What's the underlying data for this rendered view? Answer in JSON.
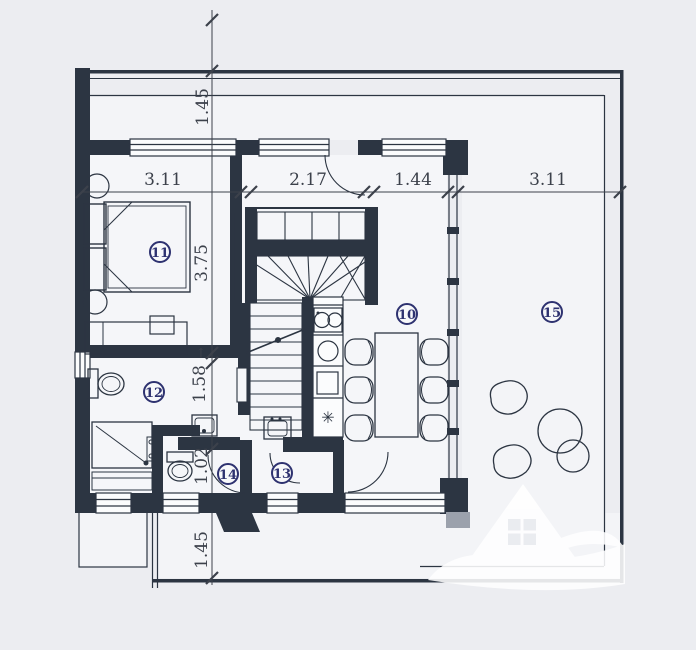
{
  "plan": {
    "type": "apartment-floor-plan",
    "rooms": [
      {
        "number": "11",
        "x": 160,
        "y": 252
      },
      {
        "number": "12",
        "x": 154,
        "y": 392
      },
      {
        "number": "14",
        "x": 228,
        "y": 474
      },
      {
        "number": "13",
        "x": 282,
        "y": 473
      },
      {
        "number": "10",
        "x": 407,
        "y": 314
      },
      {
        "number": "15",
        "x": 552,
        "y": 312
      }
    ],
    "dimensions": {
      "horizontal": [
        {
          "label": "3.11",
          "x": 163,
          "y": 180
        },
        {
          "label": "2.17",
          "x": 308,
          "y": 180
        },
        {
          "label": "1.44",
          "x": 413,
          "y": 180
        },
        {
          "label": "3.11",
          "x": 548,
          "y": 180
        }
      ],
      "vertical": [
        {
          "label": "1.45",
          "x": 203,
          "y": 107
        },
        {
          "label": "3.75",
          "x": 202,
          "y": 263
        },
        {
          "label": "1.58",
          "arrow": "↑",
          "x": 200,
          "y": 384
        },
        {
          "label": "1.02",
          "x": 202,
          "y": 466
        },
        {
          "label": "1.45",
          "x": 202,
          "y": 550
        }
      ]
    },
    "symbols": {
      "fridge": "✳"
    },
    "colors": {
      "wall": "#2c3542",
      "accent": "#2e3270",
      "dim_text": "#3c414b",
      "background": "#ecedf1",
      "floor": "#f5f6f9"
    }
  }
}
